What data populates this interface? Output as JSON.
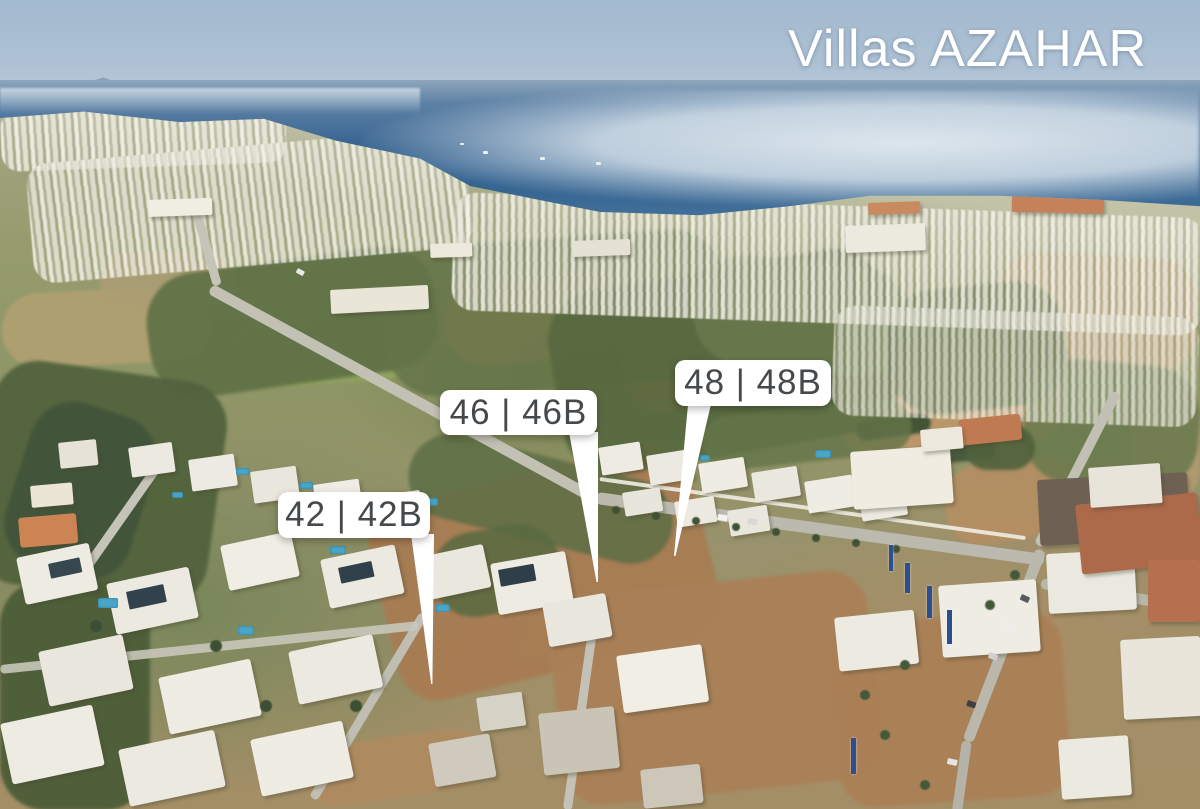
{
  "title": "Villas AZAHAR",
  "markers": [
    {
      "id": "42",
      "label": "42 | 42B"
    },
    {
      "id": "46",
      "label": "46 | 46B"
    },
    {
      "id": "48",
      "label": "48 | 48B"
    }
  ],
  "palette": {
    "title_text": "#ffffff",
    "marker_background": "#ffffff",
    "marker_text": "#45494c"
  }
}
